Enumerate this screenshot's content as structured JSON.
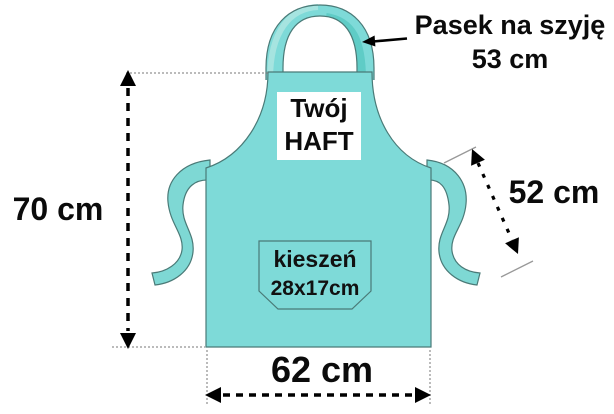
{
  "apron": {
    "embroidery": {
      "line1": "Twój",
      "line2": "HAFT"
    },
    "pocket": {
      "line1": "kieszeń",
      "line2": "28x17cm"
    },
    "dimensions": {
      "neck_strap_label": "Pasek na szyję",
      "neck_strap_value": "53 cm",
      "height": "70 cm",
      "waist_tie": "52 cm",
      "width": "62 cm"
    },
    "colors": {
      "apron_fill": "#7EDAD8",
      "tie_fill": "#7ED8D4",
      "strap_light": "#A6E4E0",
      "strap_dark": "#5FCCC6",
      "outline": "#4a7a77",
      "annotation": "#000000",
      "guide": "#777777",
      "background": "#ffffff"
    }
  }
}
